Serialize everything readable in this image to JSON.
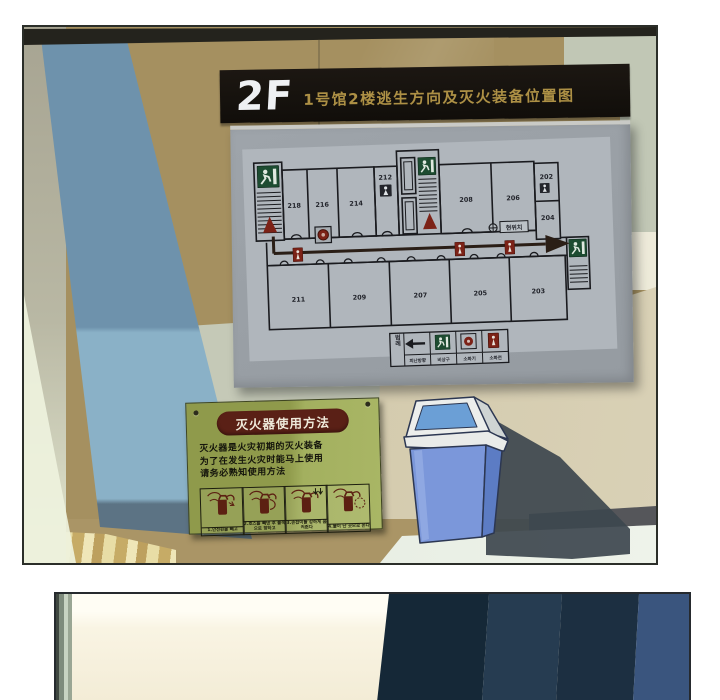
{
  "panel1": {
    "map_sign": {
      "floor_label": "2F",
      "title": "1号馆2楼逃生方向及灭火装备位置图",
      "plan": {
        "rooms_top": [
          "218",
          "216",
          "214"
        ],
        "room_wc_top": "212",
        "rooms_top_right": [
          "208",
          "206"
        ],
        "rooms_right_col": [
          "202",
          "204"
        ],
        "rooms_bottom": [
          "211",
          "209",
          "207",
          "205",
          "203"
        ],
        "marker_label": "현위치",
        "legend_title": "범례",
        "legend_items": [
          "피난방향",
          "비상구",
          "소화기",
          "소화전"
        ]
      }
    },
    "extinguisher_sign": {
      "title": "灭火器使用方法",
      "body_lines": [
        "灭火器是火灾初期的灭火装备",
        "为了在发生火灾时能马上使用",
        "请务必熟知使用方法"
      ],
      "step_captions": [
        "1.안전핀을 빼고",
        "2.호스를 빼낸 후 불쪽으로 향하고",
        "3.손잡이를 강하게 움켜쥔다",
        "4.불이 난 곳으로 쏜다"
      ]
    },
    "colors": {
      "wall_tan": "#a59060",
      "pillar_blue": "#7ea8bf",
      "board_gray": "#9ba1a7",
      "header_black": "#171310",
      "title_gold": "#ad9045",
      "accent_red": "#7c2217",
      "exit_green": "#1d4c31",
      "sign_olive": "#97a250",
      "sign_title_maroon": "#5a2016",
      "trash_blue": "#7b97da",
      "floor_light": "#e8eee3",
      "panel2_navy": "#152837",
      "panel2_cream": "#f9f4e3"
    }
  }
}
